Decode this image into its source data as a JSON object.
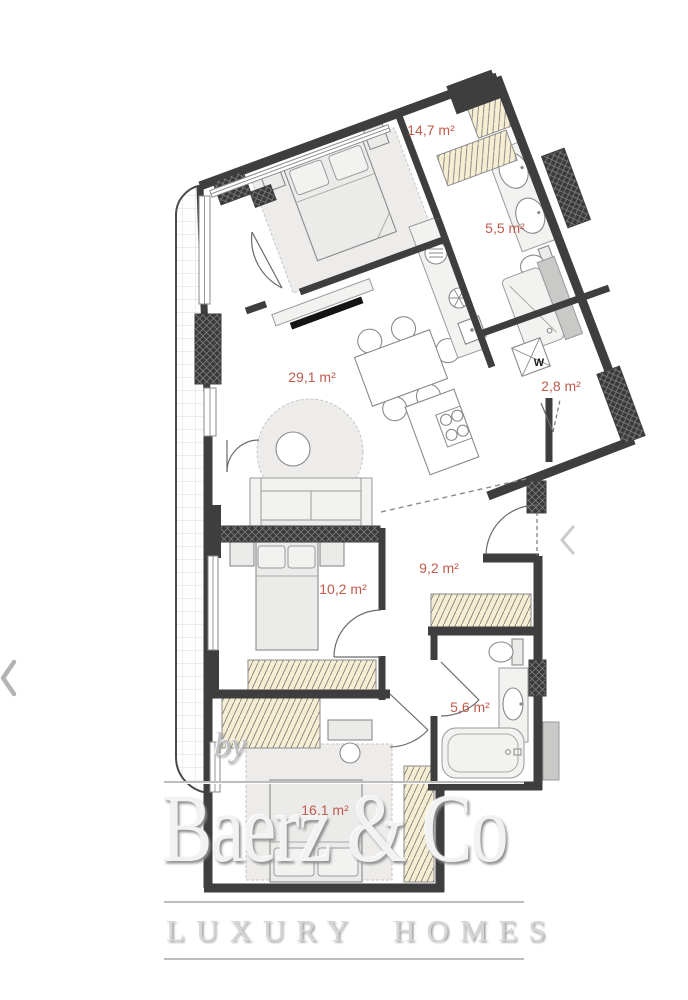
{
  "page": {
    "background": "#ffffff"
  },
  "floor_plan": {
    "rooms": [
      {
        "name": "bedroom-1",
        "area_label": "14,7 m²"
      },
      {
        "name": "bathroom-1",
        "area_label": "5,5 m²"
      },
      {
        "name": "living-kitchen",
        "area_label": "29,1 m²"
      },
      {
        "name": "wc",
        "area_label": "2,8 m²"
      },
      {
        "name": "bedroom-2",
        "area_label": "10,2 m²"
      },
      {
        "name": "hallway",
        "area_label": "9,2 m²"
      },
      {
        "name": "bathroom-2",
        "area_label": "5,6 m²"
      },
      {
        "name": "bedroom-3",
        "area_label": "16,1 m²"
      }
    ],
    "annotations": {
      "washing_machine": "W"
    },
    "colors": {
      "wall": "#3e3e3e",
      "room_label": "#bf5a4c",
      "wardrobe_fill": "#f6eed3",
      "furniture_fill": "#ebebe9",
      "furniture_stroke": "#8a8a8a",
      "tile_line": "#dcdcdc",
      "shaft_gray": "#c9c9c7",
      "watermark_gray": "#c2c2c2"
    }
  },
  "watermark": {
    "by": "by",
    "brand": "Baerz & Co",
    "tagline": "LUXURY HOMES"
  },
  "nav": {
    "prev_icon": "chevron-left"
  }
}
